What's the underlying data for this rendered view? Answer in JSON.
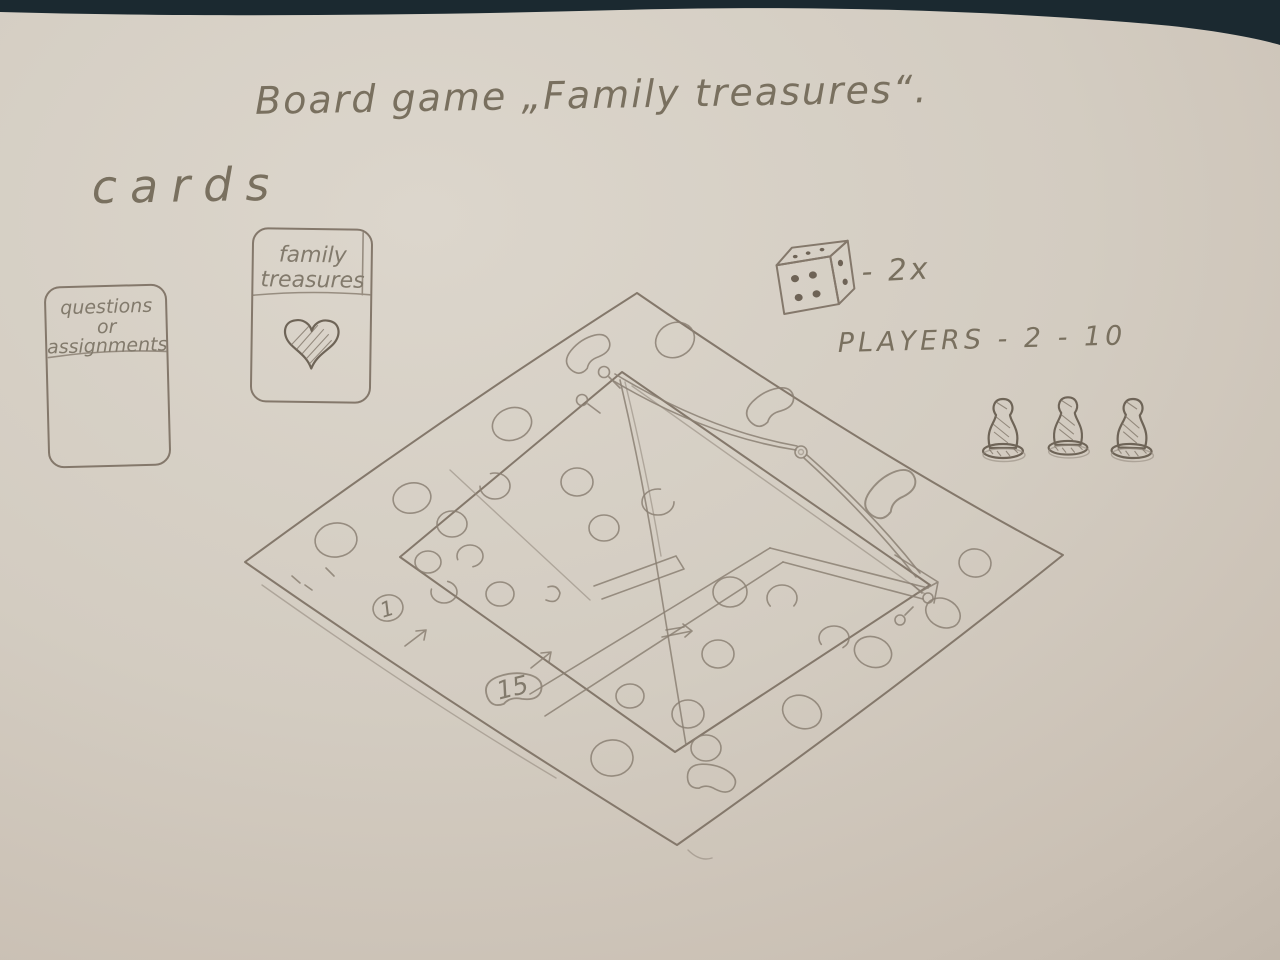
{
  "scene": {
    "description": "photo of a pencil sketch on paper: board game design",
    "background_color": "#1b2930",
    "paper_color_light": "#dcd6cc",
    "paper_color_dark": "#bfb5a9",
    "pencil_color": "#84786b"
  },
  "title": "Board game „Family treasures“.",
  "cards_section": {
    "label": "cards",
    "card_questions": {
      "line1": "questions",
      "line2": "or",
      "line3": "assignments"
    },
    "card_family": {
      "line1": "family",
      "line2": "treasures"
    }
  },
  "dice": {
    "label": "- 2x",
    "front_pips": 4,
    "side_pips": 2,
    "top_pips": 3
  },
  "players": {
    "label": "PLAYERS - 2 - 10",
    "pawn_count": 3
  },
  "board": {
    "space_1": "1",
    "space_15": "15"
  },
  "icons": {
    "dice": "dice-icon",
    "heart": "heart-icon",
    "pawn": "pawn-icon",
    "pin": "pin-icon",
    "string": "clothesline-string",
    "arrow": "direction-arrow"
  }
}
